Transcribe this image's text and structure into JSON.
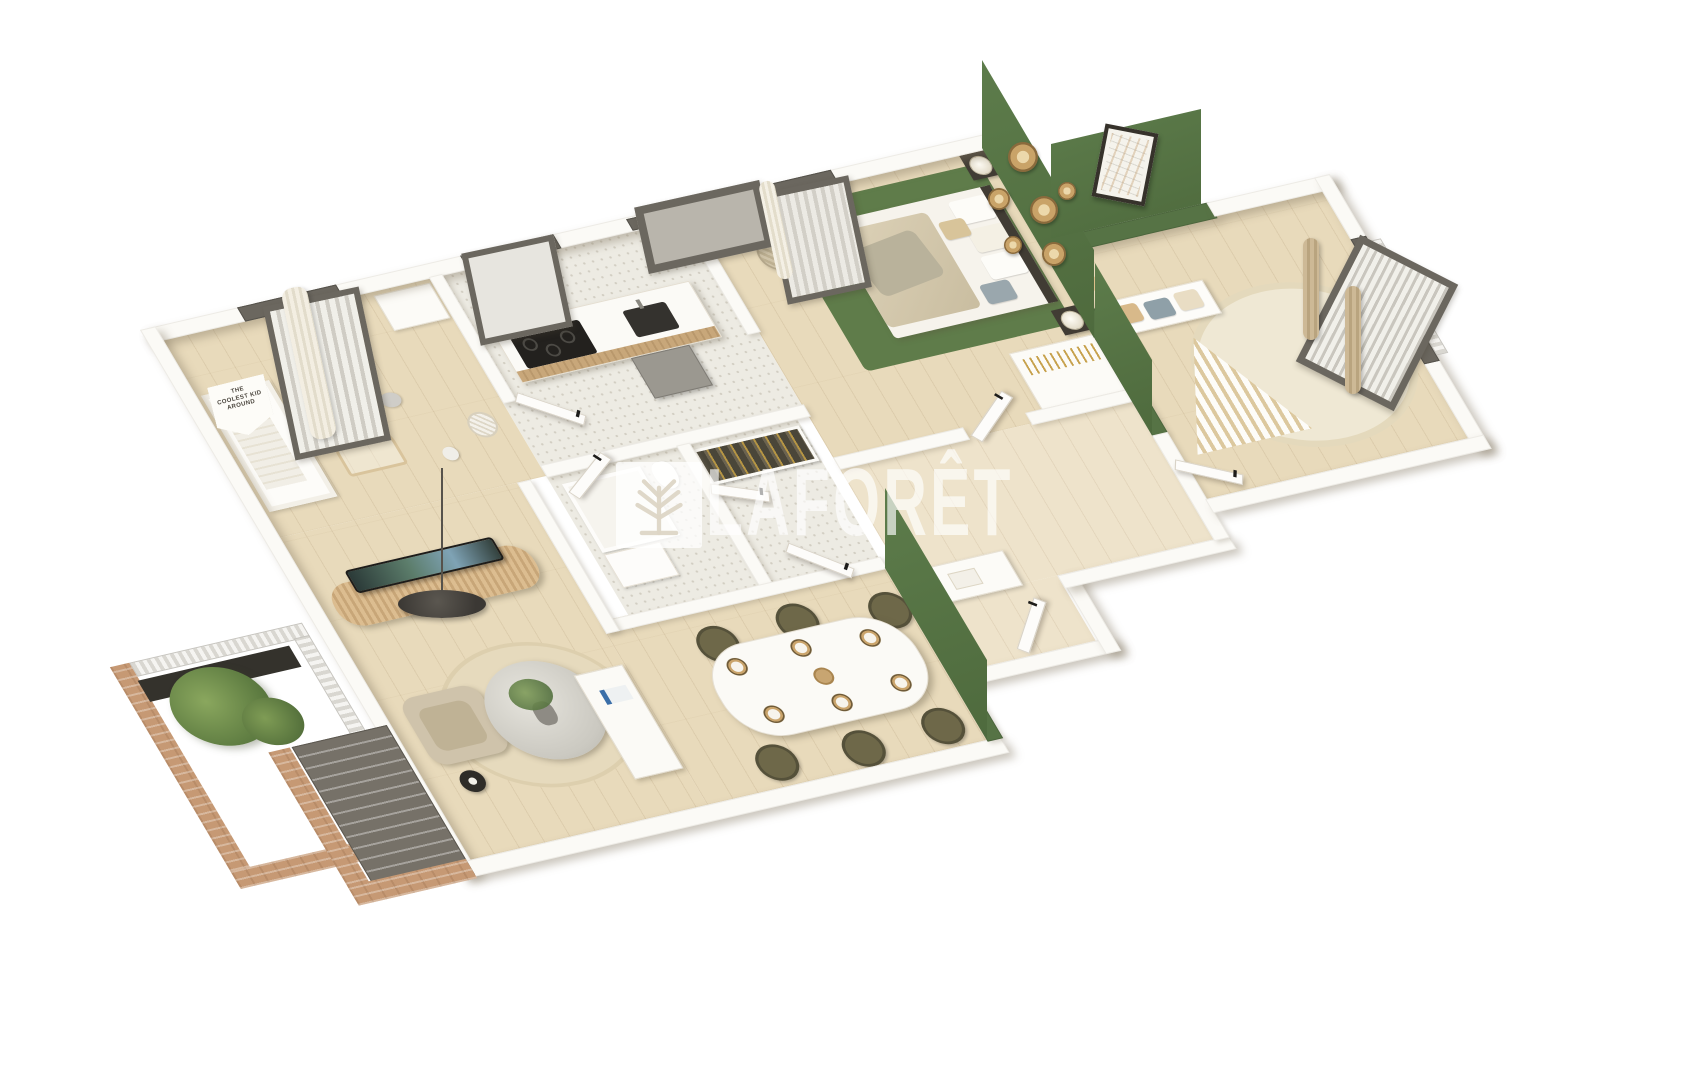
{
  "watermark": {
    "brand_text": "LAFORÊT",
    "logo": "laforet-tree-logo"
  },
  "nursery_sign": {
    "text": "THE COOLEST KID AROUND"
  },
  "colors": {
    "background": "#ffffff",
    "wall": "#fbfaf6",
    "accent_green": "#567345",
    "rug_green": "#5f7c4a",
    "wood": "#e8dabb",
    "wood_light": "#eee3cb",
    "terrazzo": "#edebe3",
    "brick": "#c69974",
    "frame_dark": "#6b675f",
    "rattan": "#d7b98b",
    "beige": "#cfc3ab",
    "curtain_beige": "#c9b593"
  },
  "scene": {
    "type": "3d-floor-plan",
    "style": "axonometric apartment render on white background with translucent brand watermark",
    "rooms": [
      {
        "name": "nursery",
        "floor": "wood",
        "items": [
          "crib",
          "wall-sign",
          "window-with-curtain",
          "baby-play-gym",
          "plush-toys",
          "wall-shelf",
          "round-basket"
        ]
      },
      {
        "name": "kitchen",
        "floor": "terrazzo",
        "items": [
          "island-with-black-cooktop-and-sink",
          "oven",
          "woven-laundry-basket",
          "slot-window",
          "square-window"
        ]
      },
      {
        "name": "master-bedroom",
        "floor": "wood",
        "items": [
          "double-bed-beige-bedding",
          "green-accent-wall",
          "six-woven-wall-plates",
          "two-nightstands-with-lamps",
          "green-rug",
          "curtained-window"
        ]
      },
      {
        "name": "kids-bedroom",
        "floor": "wood",
        "items": [
          "green-accent-wall",
          "framed-art",
          "teepee-play-tent",
          "cushion-bench",
          "round-cream-rug",
          "rocking-zebra",
          "french-window-with-beige-curtains",
          "railing"
        ]
      },
      {
        "name": "bathroom-and-closets",
        "floor": "terrazzo",
        "items": [
          "shower",
          "vanity",
          "toilet",
          "wardrobe-with-hanging-clothes"
        ]
      },
      {
        "name": "hallway",
        "floor": "wood",
        "items": [
          "wardrobe-with-gold-hangers",
          "desk-nook",
          "interior-doors"
        ]
      },
      {
        "name": "living-room",
        "floor": "wood",
        "items": [
          "curved-tv-on-rattan-sideboard",
          "black-pendant-disc-lamp",
          "beige-armchair",
          "round-glass-coffee-table-with-plant",
          "black-side-table",
          "white-console-bench-with-book",
          "jute-rug"
        ]
      },
      {
        "name": "dining-area",
        "floor": "wood",
        "items": [
          "white-table-six-place-settings",
          "six-olive-chairs",
          "green-partition-wall"
        ]
      },
      {
        "name": "balcony",
        "floor": "outdoor",
        "items": [
          "brick-parapet",
          "slatted-railing",
          "green-tree",
          "dark-planter",
          "exterior-staircase"
        ]
      }
    ]
  }
}
